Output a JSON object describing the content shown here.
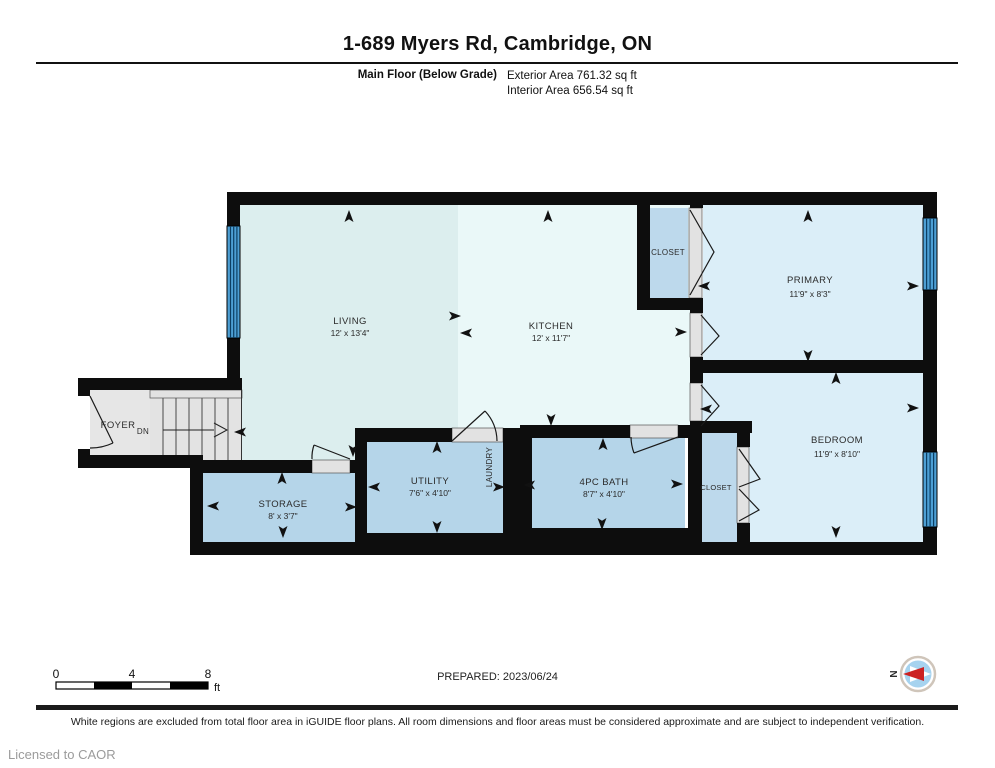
{
  "header": {
    "title": "1-689 Myers Rd, Cambridge, ON",
    "floor_label": "Main Floor (Below Grade)",
    "exterior_area": "Exterior Area 761.32 sq ft",
    "interior_area": "Interior Area 656.54 sq ft"
  },
  "rooms": {
    "living": {
      "name": "LIVING",
      "dims": "12' x 13'4\""
    },
    "kitchen": {
      "name": "KITCHEN",
      "dims": "12' x 11'7\""
    },
    "primary": {
      "name": "PRIMARY",
      "dims": "11'9\" x 8'3\""
    },
    "bedroom": {
      "name": "BEDROOM",
      "dims": "11'9\" x 8'10\""
    },
    "bath": {
      "name": "4PC BATH",
      "dims": "8'7\" x 4'10\""
    },
    "utility": {
      "name": "UTILITY",
      "dims": "7'6\" x 4'10\""
    },
    "storage": {
      "name": "STORAGE",
      "dims": "8' x 3'7\""
    },
    "laundry": {
      "name": "LAUNDRY"
    },
    "foyer": {
      "name": "FOYER"
    },
    "stairs": {
      "direction_label": "DN"
    },
    "closet_primary": {
      "name": "CLOSET"
    },
    "closet_bedroom": {
      "name": "CLOSET"
    }
  },
  "scale_bar": {
    "ticks": [
      "0",
      "4",
      "8"
    ],
    "unit": "ft"
  },
  "compass": {
    "north_label": "N"
  },
  "footer": {
    "prepared": "PREPARED: 2023/06/24",
    "disclaimer": "White regions are excluded from total floor area in iGUIDE floor plans. All room dimensions and floor areas must be considered approximate and are subject to independent verification.",
    "license": "Licensed to CAOR"
  },
  "colors": {
    "wall": "#0d0d0d",
    "living_kitchen_left": "#dceeee",
    "kitchen_right": "#eaf8f8",
    "bedrooms": "#dbeef8",
    "wet_rooms": "#b5d5e9",
    "closets": "#bdd9ec",
    "foyer_gray": "#e6e6e6",
    "window_blue": "#4d9fd4",
    "compass_needle_red": "#cc2222"
  }
}
